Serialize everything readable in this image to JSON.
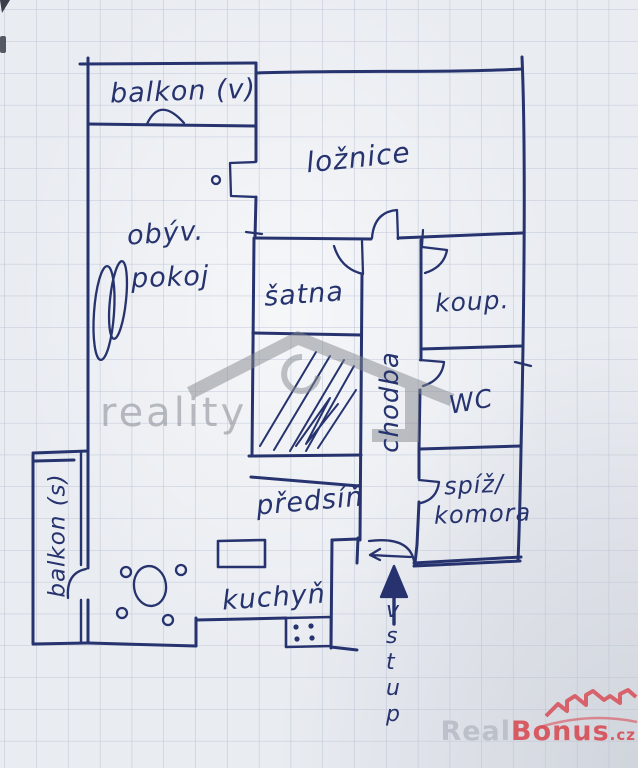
{
  "palette": {
    "paper": "#e9ecf1",
    "grid_line": "#b7c0d3",
    "ink": "#26336e",
    "watermark_gray": "#85888f",
    "brand_gray": "#b7bbc5",
    "brand_red": "#d8454e"
  },
  "plan": {
    "type_note": "hand-drawn apartment floor plan on graph paper",
    "rooms": {
      "balkon_v": "balkon (v)",
      "loznice": "ložnice",
      "obyv_line1": "obýv.",
      "obyv_line2": "pokoj",
      "satna": "šatna",
      "koupelna": "koup.",
      "wc": "WC",
      "chodba": "chodba",
      "spiz_line1": "spíž/",
      "spiz_line2": "komora",
      "predsin": "předsíň",
      "kuchyn": "kuchyň",
      "balkon_s": "balkon (s)",
      "vstup": "vstup"
    }
  },
  "watermarks": {
    "agency_text": "reality",
    "brand_part1": "Real",
    "brand_part2": "Bonus",
    "brand_tld": ".cz"
  }
}
